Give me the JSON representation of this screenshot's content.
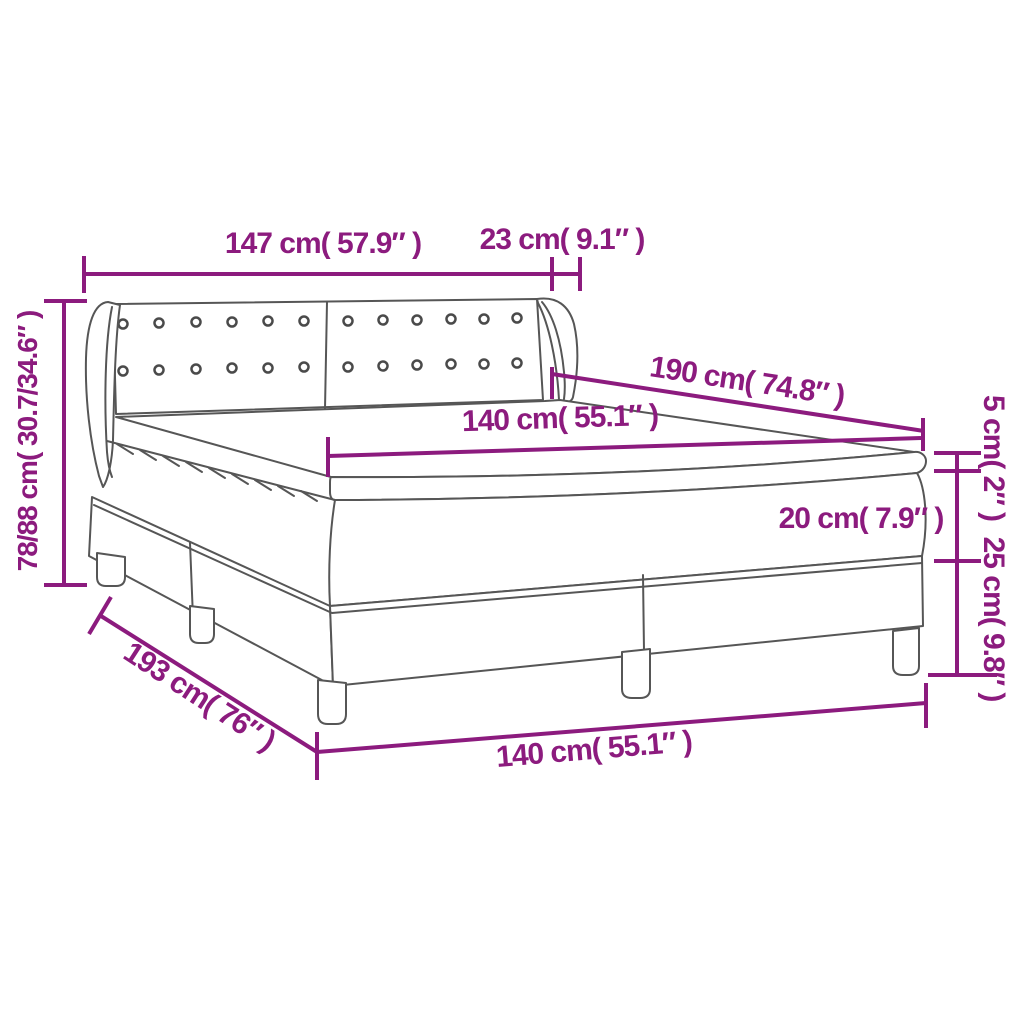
{
  "diagram": {
    "kind": "product-dimension-diagram",
    "subject": "box spring bed with headboard, mattress and topper",
    "background_color": "#FFFFFF",
    "accent_color": "#8C1B7E",
    "drawing_line_color": "#565656",
    "dimensions": {
      "headboard_width": "147 cm( 57.9″ )",
      "headboard_wing_depth": "23 cm( 9.1″ )",
      "bed_length": "190 cm( 74.8″ )",
      "mattress_width_top": "140 cm( 55.1″ )",
      "overall_height": "78/88 cm( 30.7/34.6″ )",
      "topper_height": "5 cm( 2″ )",
      "mattress_height": "20 cm( 7.9″ )",
      "base_height": "25 cm( 9.8″ )",
      "frame_length": "193 cm( 76″ )",
      "frame_width_bottom": "140 cm( 55.1″ )"
    }
  }
}
